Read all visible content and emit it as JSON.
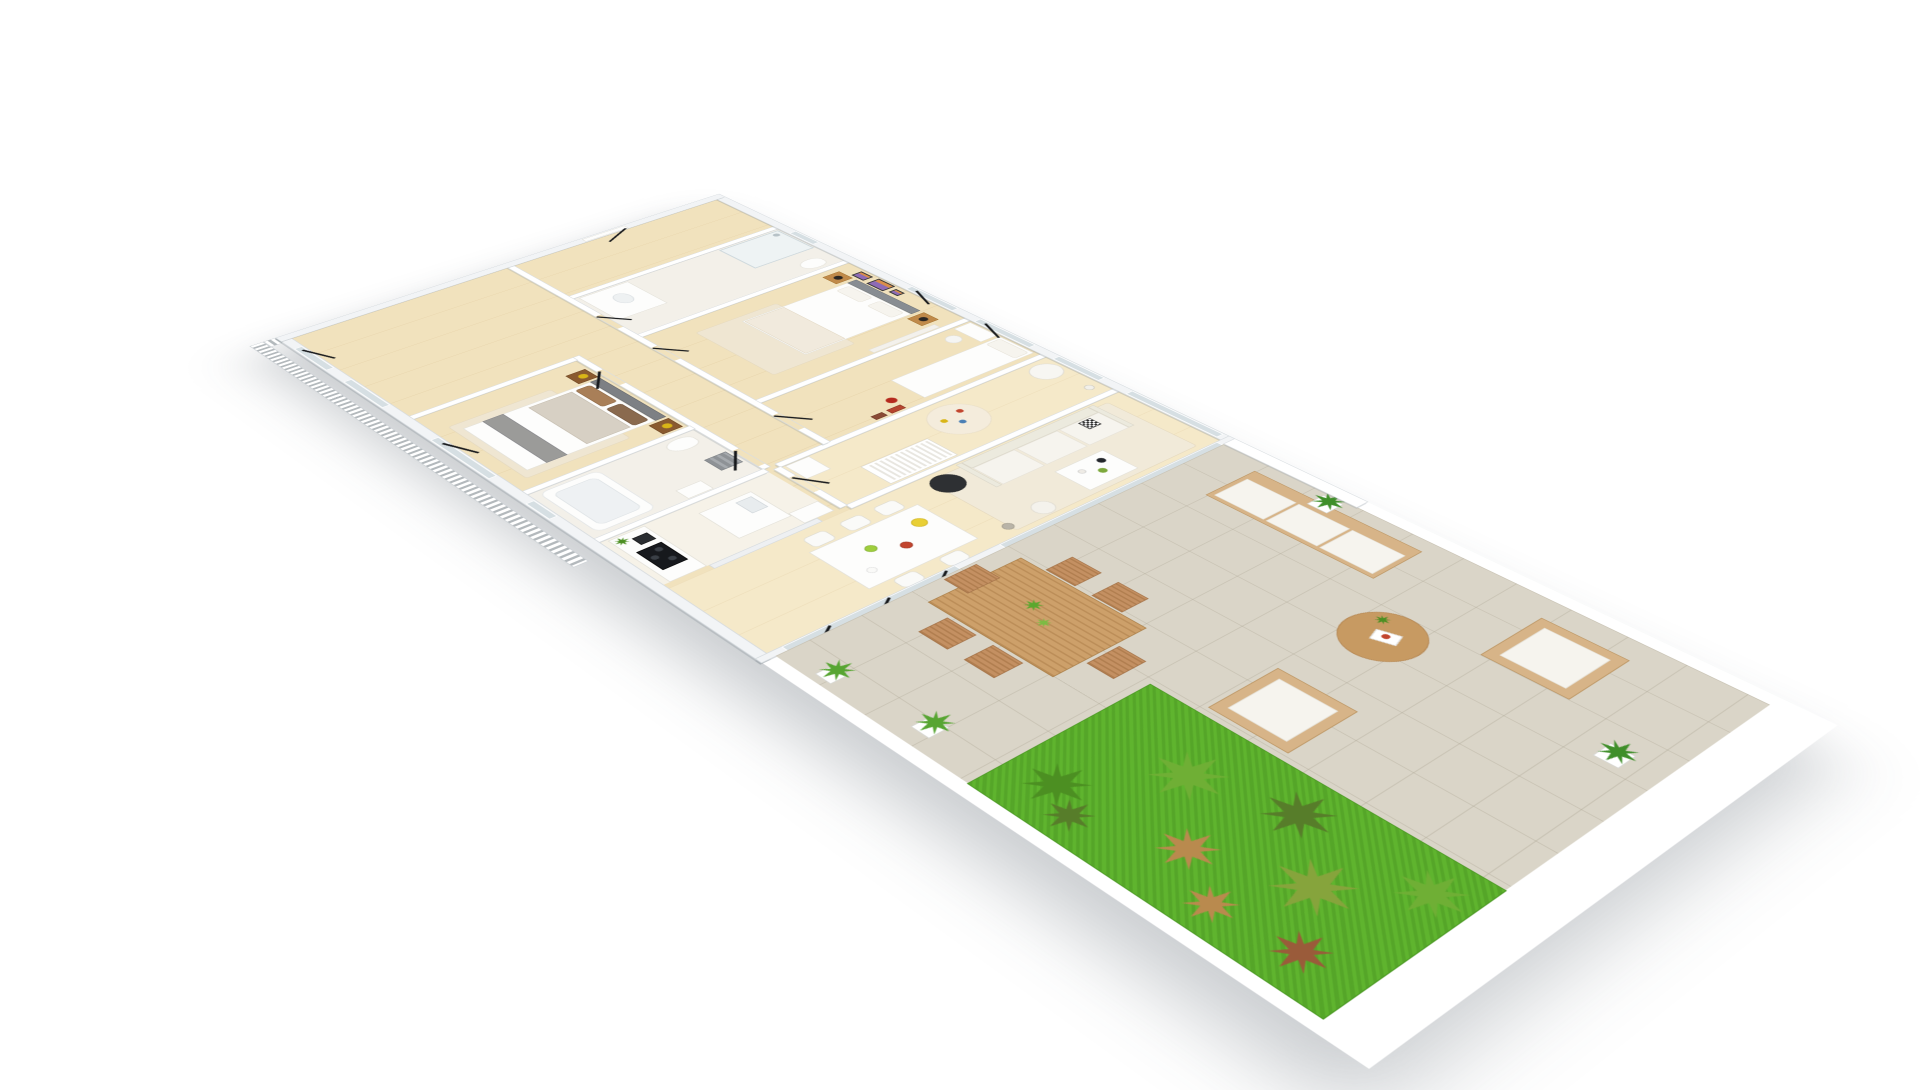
{
  "scene": {
    "description": "3D isometric aerial rendering of a furnished three-bedroom apartment floor plan with open living-dining-kitchen and a large tiled terrace bordered by a lawn strip and white picket railing",
    "view": "isometric aerial, rotated clockwise ~30 degrees",
    "background_color": "#ffffff",
    "visible_text": "none"
  },
  "palette": {
    "wall": "#ffffff",
    "wall_edge": "#d9dde1",
    "outer_wall": "#f2f4f6",
    "wood_floor": "#f1e2bd",
    "bath_floor": "#f3f0e9",
    "terrace_tile": "#dad5c8",
    "grass": "#5fb42e",
    "railing": "#e9ecee",
    "outdoor_wood": "#d7b488",
    "indoor_wood_furniture": "#c08a4a",
    "black_accent": "#17191d",
    "art_purple": "#8e6bb5",
    "art_orange": "#d98e4a",
    "fruit_yellow": "#e9cf35",
    "fruit_green": "#9fce3d",
    "fruit_red": "#c2452e",
    "lamp_yellow": "#d9b517",
    "ball_red": "#b5291d",
    "cushion_pattern": "#2b2b2b",
    "glass": "#d6dfe3"
  },
  "rooms": [
    {
      "name": "Entry hall",
      "floor": "wood",
      "items": [
        "white entry door with black open-door stroke"
      ]
    },
    {
      "name": "Bathroom 1",
      "floor": "light tile",
      "items": [
        "walk-in glass shower",
        "vanity with sink",
        "toilet"
      ]
    },
    {
      "name": "Master bedroom",
      "floor": "wood",
      "items": [
        "double bed with grey headboard",
        "2 wooden nightstands",
        "2 black mushroom table lamps",
        "3 lavender-landscape wall artworks",
        "beige area rug",
        "curtained window"
      ]
    },
    {
      "name": "Bedroom 2",
      "floor": "wood",
      "items": [
        "single bed",
        "white desk",
        "white shell chair",
        "red ball",
        "wall shelf with red boxes"
      ]
    },
    {
      "name": "Nursery",
      "floor": "wood",
      "items": [
        "white crib",
        "round white armchair",
        "round play rug with toys",
        "floor lamp",
        "white storage unit"
      ]
    },
    {
      "name": "Hallway",
      "floor": "wood",
      "items": [
        "windows on front facade with black open-window strokes"
      ]
    },
    {
      "name": "Bedroom 3",
      "floor": "wood",
      "items": [
        "double bed with brown pillows",
        "grey bed runner",
        "2 dark-wood floating nightstands",
        "2 yellow lamps",
        "front window"
      ]
    },
    {
      "name": "Bathroom 2",
      "floor": "light tile",
      "items": [
        "bathtub",
        "toilet",
        "washbasin",
        "stack of grey towels"
      ]
    },
    {
      "name": "Kitchen",
      "floor": "light tile",
      "items": [
        "island with sink",
        "black induction cooktop",
        "black coffee machine",
        "fridge column",
        "potted plant",
        "glass shelving divider"
      ]
    },
    {
      "name": "Living room",
      "floor": "wood",
      "items": [
        "white three-seat sofa",
        "black-and-white patterned cushion",
        "black round pouf side table",
        "white coffee table with vases",
        "white pouf",
        "floor lamp",
        "beige rug",
        "tall french windows with balcony railings"
      ]
    },
    {
      "name": "Dining area",
      "floor": "wood",
      "items": [
        "white dining table",
        "5 white chairs",
        "bowl of bananas",
        "bowl of red fruit",
        "bowl of green apples",
        "white dish"
      ]
    }
  ],
  "terrace": {
    "name": "Terrace",
    "floor": "large beige-grey tiles",
    "boundary": [
      "white parapet wall near building",
      "white picket railing on three outer sides",
      "lawn border strip along outer edge"
    ],
    "furniture": [
      "wooden 3-seat outdoor sofa with white cushions",
      "2 wooden outdoor armchairs with white cushions",
      "round wooden coffee table with magazine and mini plant",
      "wooden slatted dining table with 2 mini plants",
      "6 wooden folding chairs",
      "4 potted green plants in white planters"
    ],
    "lawn": {
      "color": "#5fb42e",
      "plants": "9 ornamental grass clumps in green, olive, tan and rust tones"
    }
  },
  "annotations": {
    "door_marks": "thin black diagonal strokes marking open doors, windows and folding glass doors",
    "shadow": "soft grey ground shadow beneath the model"
  }
}
